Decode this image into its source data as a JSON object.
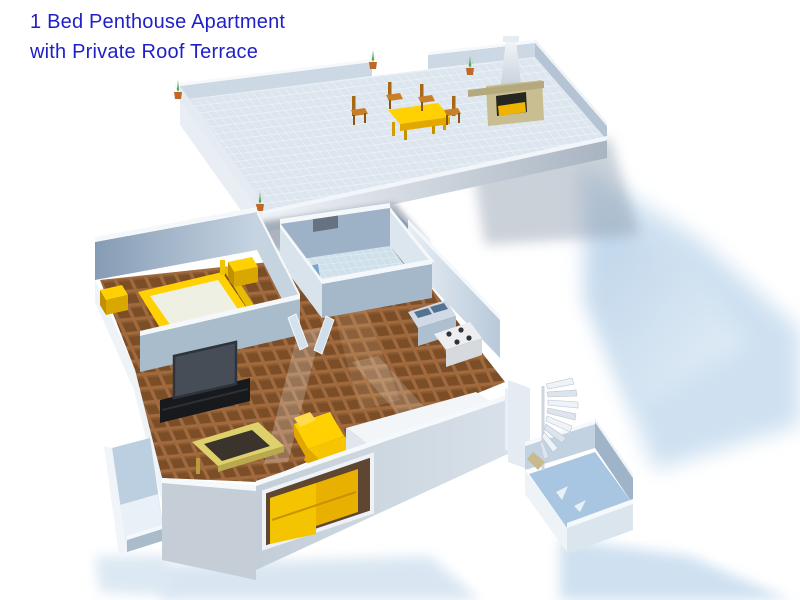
{
  "title": {
    "line1": "1 Bed Penthouse Apartment",
    "line2": "with Private Roof Terrace"
  },
  "colors": {
    "title_text": "#1f1fc8",
    "furniture_yellow": "#ffd103",
    "furniture_yellow_shade": "#e2a800",
    "wood_chair": "#c87f28",
    "wall_light": "#d9e4ee",
    "wall_shaded": "#9fb4c8",
    "wall_cap_white": "#f6f9fc",
    "floor_brown": "#a06a3e",
    "floor_tile_dark": "#7c4e28",
    "bath_tile": "#cfe0ea",
    "terrace_tile": "#dde6ee",
    "shadow_blue": "#cfe1f1",
    "toilet_blue": "#6090c0",
    "cabinet_blue": "#7e95ad",
    "tv_dark": "#474d56",
    "stand_black": "#17191c",
    "bbq_tan": "#c9bd92",
    "plant_green": "#3f9f3f",
    "pot_orange": "#c06828"
  },
  "scene": {
    "upper_level": "private roof terrace",
    "lower_level": "one-bed apartment floor",
    "rooms": [
      "roof terrace",
      "bedroom",
      "bathroom",
      "hallway",
      "kitchen",
      "living room",
      "side balcony",
      "stair courtyard"
    ],
    "terrace_objects": [
      "dining table",
      "four chairs",
      "barbecue fireplace",
      "chimney",
      "potted plants",
      "tiled floor",
      "parapet walls"
    ],
    "apartment_objects": [
      "double bed",
      "nightstands",
      "tv on stand",
      "coffee table",
      "corner sofa",
      "kitchen island",
      "sink unit",
      "stove",
      "toilet",
      "shower tray",
      "spiral staircase",
      "open doors",
      "window opening"
    ]
  }
}
